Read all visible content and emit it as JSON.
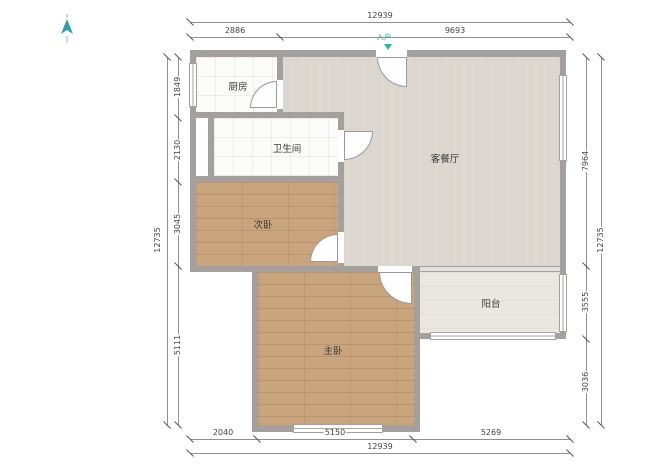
{
  "plan": {
    "entry_marker": {
      "label": "入户",
      "color": "#2fb3a3"
    },
    "rooms": {
      "kitchen": {
        "label": "厨房"
      },
      "bathroom": {
        "label": "卫生间"
      },
      "bedroom2": {
        "label": "次卧"
      },
      "living": {
        "label": "客餐厅"
      },
      "master": {
        "label": "主卧"
      },
      "balcony": {
        "label": "阳台"
      }
    },
    "dimensions": {
      "top": {
        "overall": "12939",
        "segments": [
          "2886",
          "9693"
        ]
      },
      "bottom": {
        "overall": "12939",
        "segments": [
          "2040",
          "5150",
          "5269"
        ]
      },
      "left": {
        "overall": "12735",
        "segments": [
          "1849",
          "2130",
          "3045",
          "5111"
        ]
      },
      "right": {
        "overall": "12735",
        "segments": [
          "7964",
          "3555",
          "3036"
        ]
      }
    },
    "colors": {
      "wall": "#a3a09d",
      "wood_floor": "#c9a57d",
      "living_floor": "#dbd7cf",
      "balcony_floor": "#eae7e0",
      "accent_teal": "#2fb3a3"
    }
  }
}
